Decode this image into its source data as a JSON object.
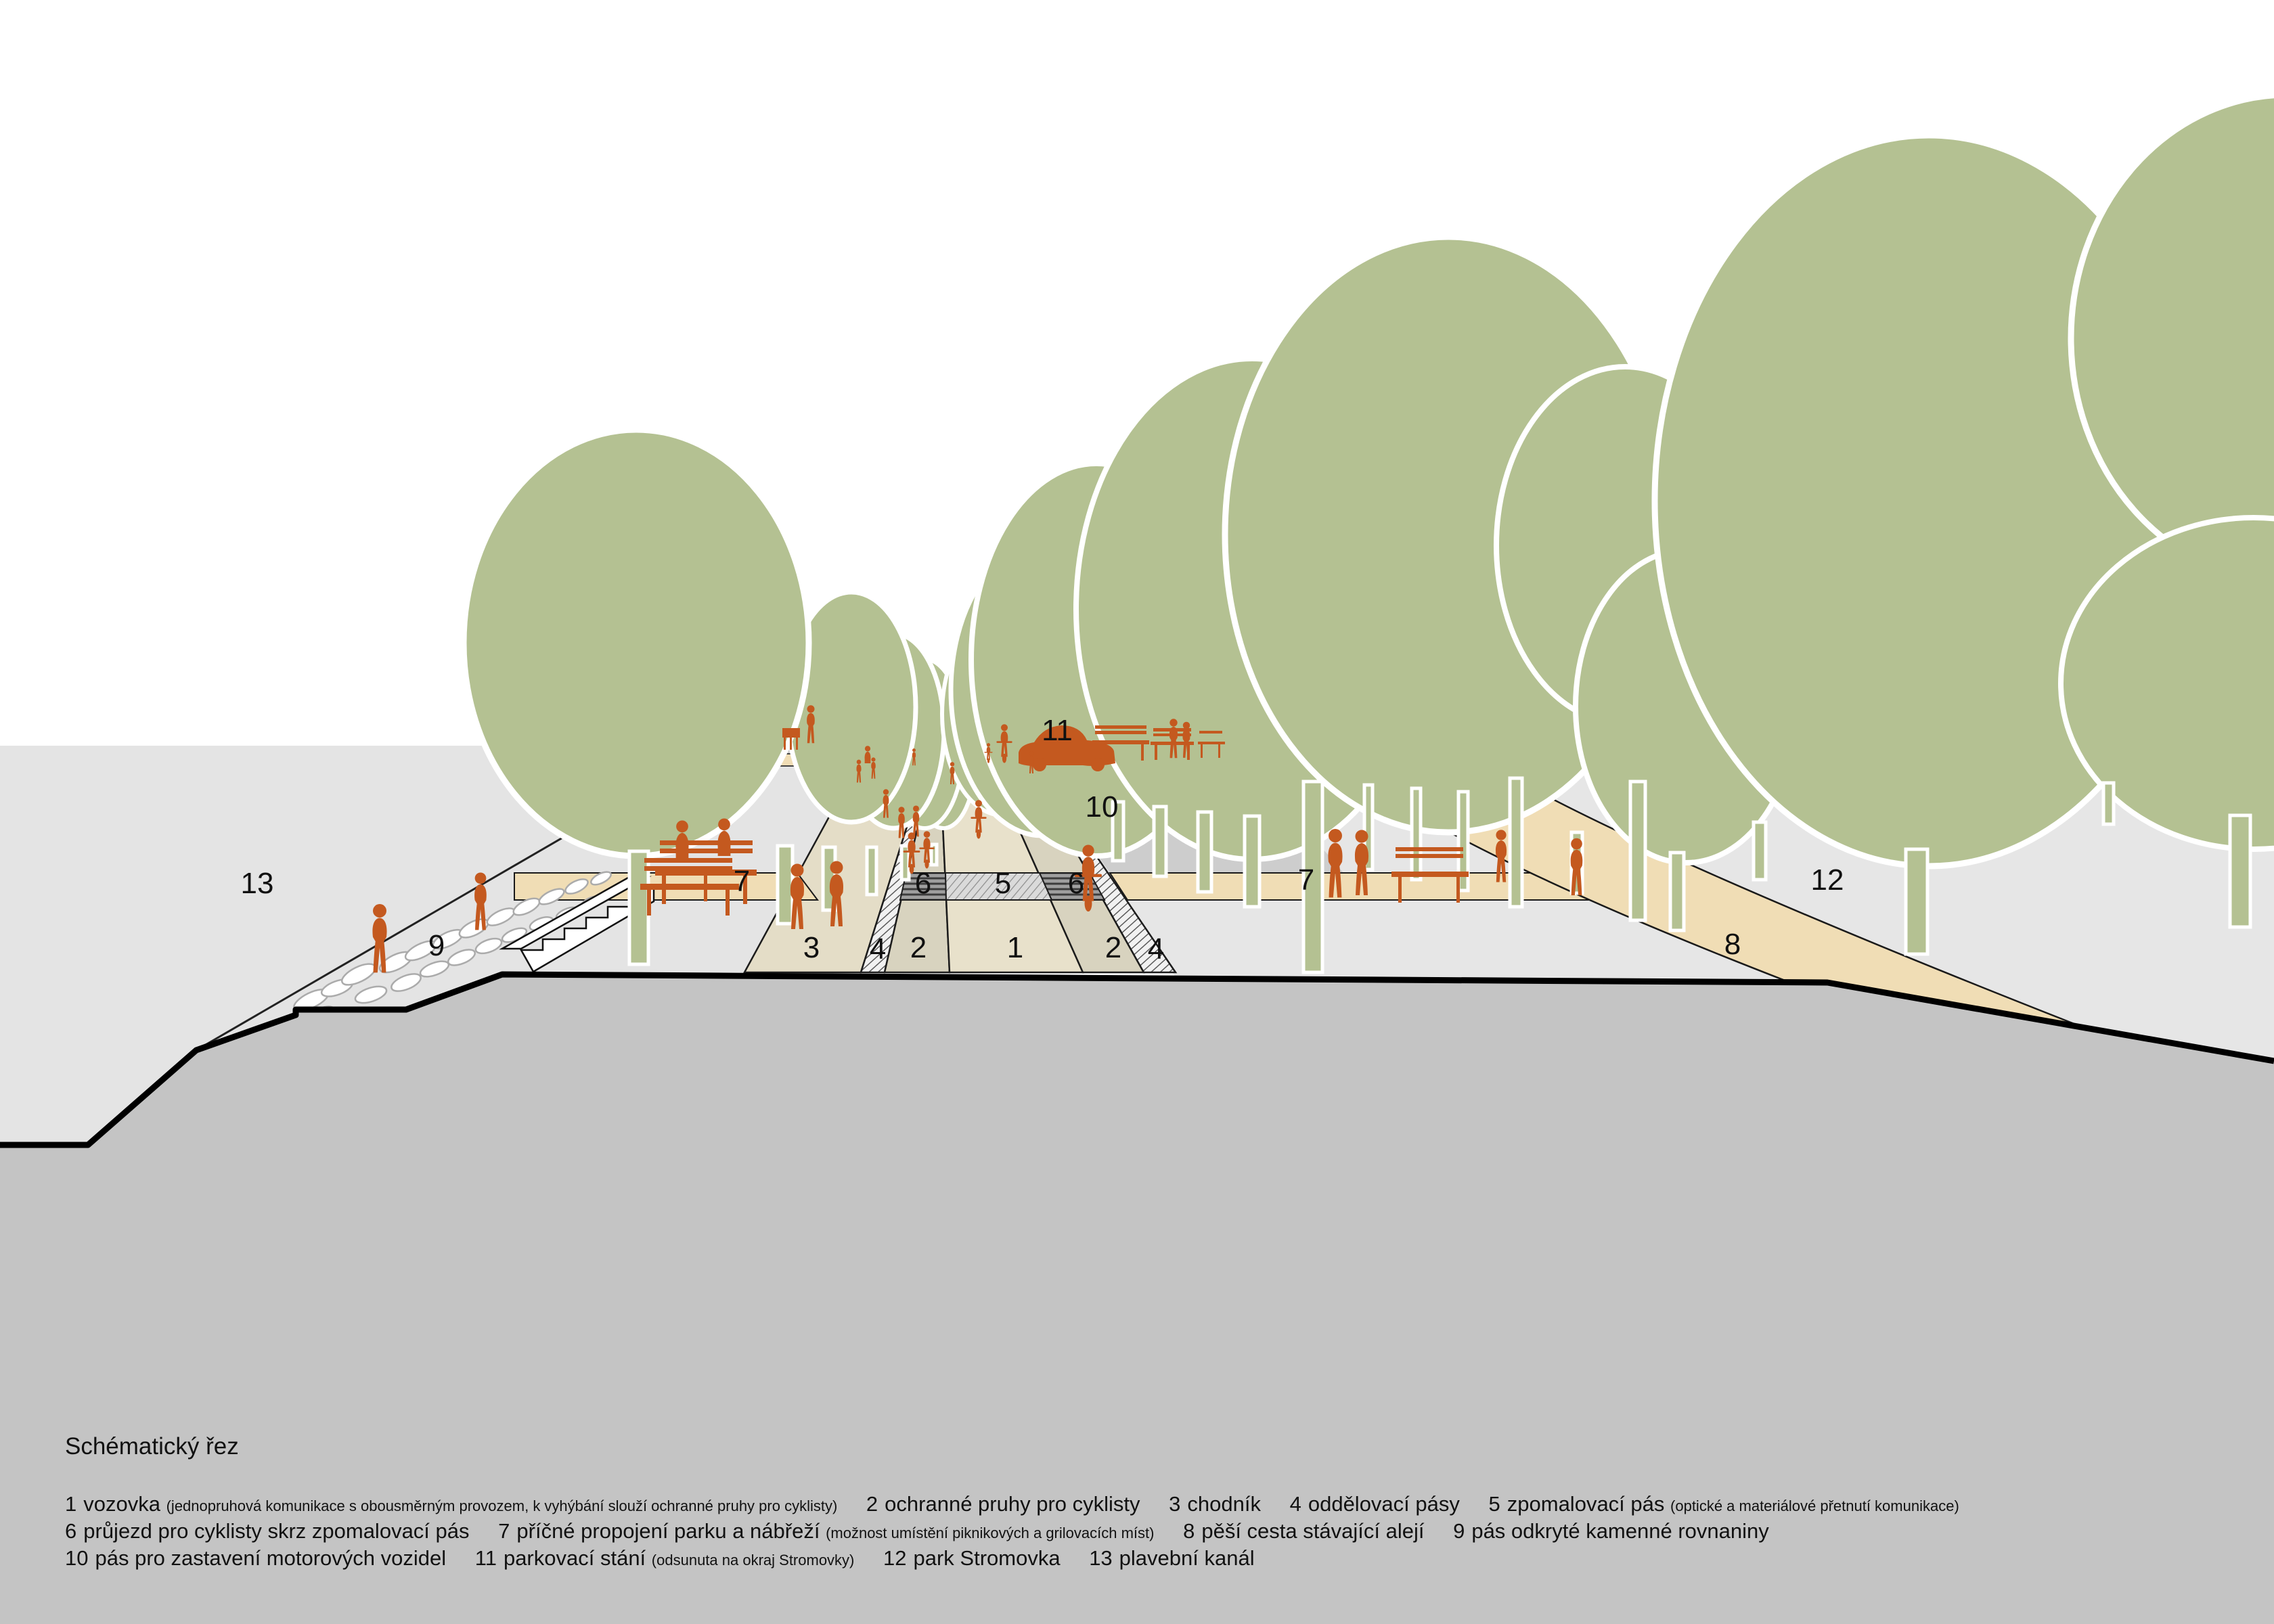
{
  "title": "Schématický řez",
  "legend": {
    "items": [
      {
        "num": "1",
        "label": "vozovka",
        "note": "(jednopruhová komunikace s obousměrným provozem, k vyhýbání slouží ochranné pruhy pro cyklisty)"
      },
      {
        "num": "2",
        "label": "ochranné pruhy pro cyklisty",
        "note": ""
      },
      {
        "num": "3",
        "label": "chodník",
        "note": ""
      },
      {
        "num": "4",
        "label": "oddělovací pásy",
        "note": ""
      },
      {
        "num": "5",
        "label": "zpomalovací pás",
        "note": "(optické a materiálové přetnutí komunikace)"
      },
      {
        "num": "6",
        "label": "průjezd pro cyklisty skrz zpomalovací pás",
        "note": ""
      },
      {
        "num": "7",
        "label": "příčné propojení parku a nábřeží",
        "note": "(možnost umístění piknikových a grilovacích míst)"
      },
      {
        "num": "8",
        "label": "pěší cesta stávající alejí",
        "note": ""
      },
      {
        "num": "9",
        "label": "pás odkryté kamenné rovnaniny",
        "note": ""
      },
      {
        "num": "10",
        "label": "pás pro zastavení motorových vozidel",
        "note": ""
      },
      {
        "num": "11",
        "label": "parkovací stání",
        "note": "(odsunuta na okraj Stromovky)"
      },
      {
        "num": "12",
        "label": "park Stromovka",
        "note": ""
      },
      {
        "num": "13",
        "label": "plavební kanál",
        "note": ""
      }
    ]
  },
  "markers": [
    "1",
    "2",
    "2",
    "3",
    "4",
    "4",
    "5",
    "6",
    "6",
    "7",
    "7",
    "8",
    "9",
    "10",
    "11",
    "12",
    "13"
  ],
  "palette": {
    "figure_orange": "#c4591f",
    "tree_green": "#b4c192",
    "path_tan": "#f0ddb5",
    "sidewalk_beige": "#e4ddc7",
    "roadway_beige": "#e8e1cb",
    "cycle_lane_beige": "#d8d3bf",
    "park_gray": "#e6e6e6",
    "parking_gray": "#cdcdcd",
    "ground_gray": "#c4c4c4",
    "line_black": "#111111"
  }
}
